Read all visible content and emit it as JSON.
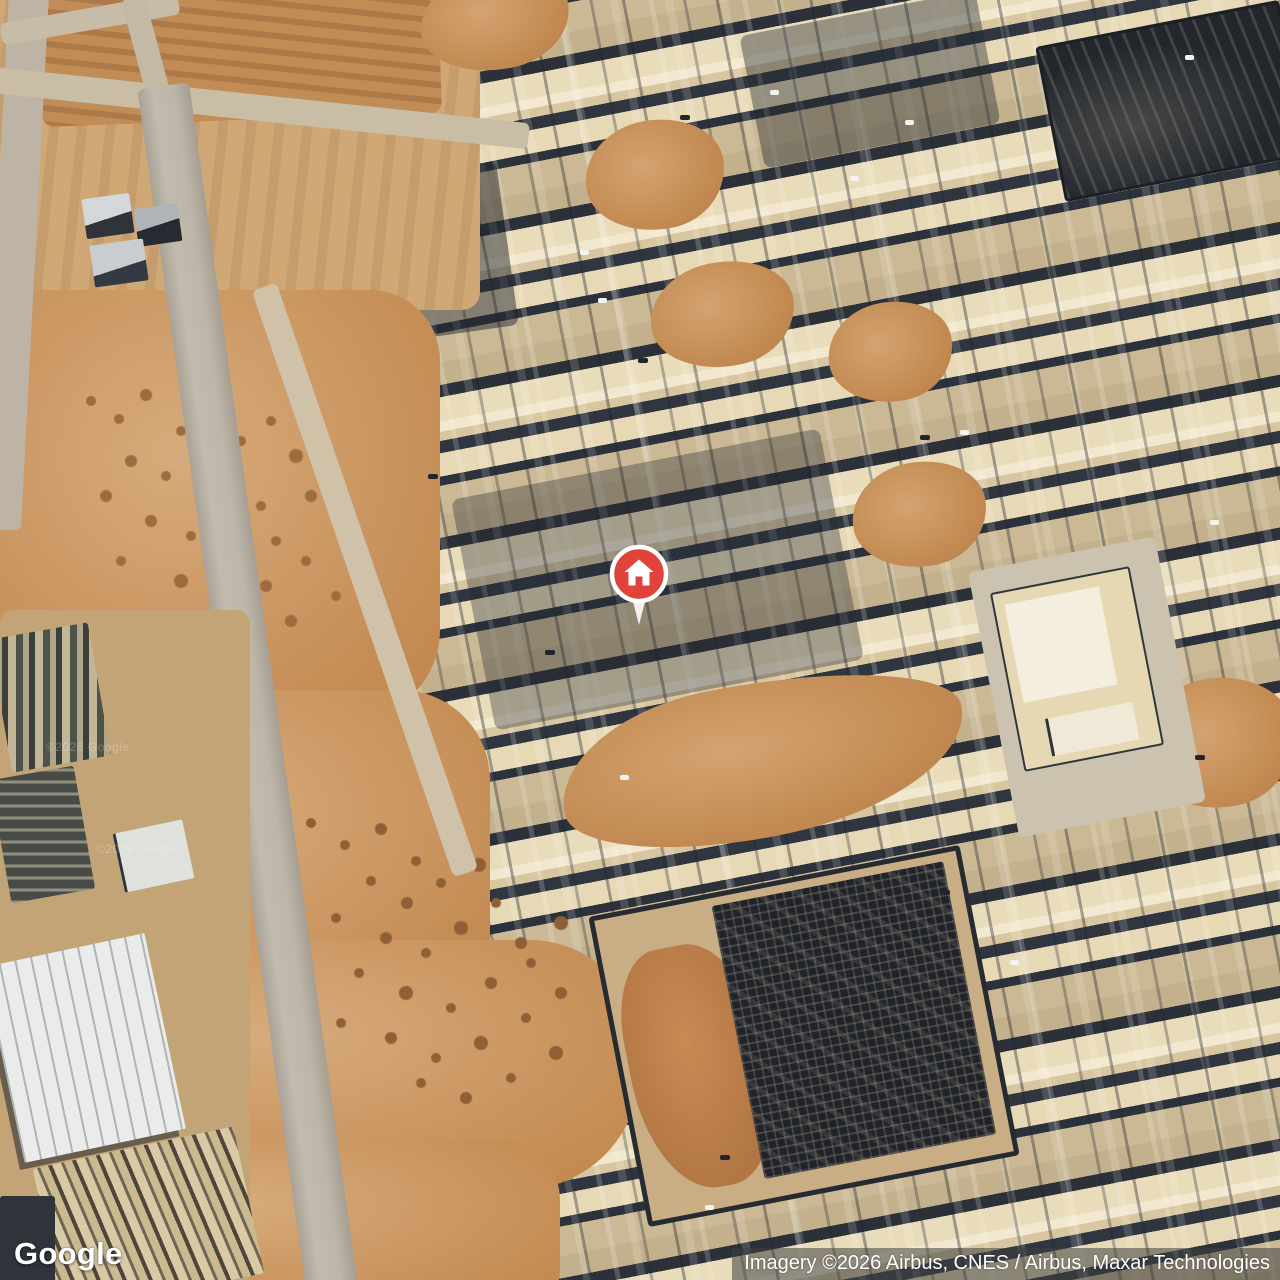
{
  "map": {
    "view": "satellite",
    "logo": "Google",
    "attribution": "Imagery ©2026 Airbus, CNES / Airbus, Maxar Technologies",
    "watermark": "©2026 Google",
    "marker": {
      "icon": "home-marker-icon",
      "color": "#DF4339",
      "x": 639,
      "y": 578
    }
  },
  "palette": {
    "desert_base": "#CDA97A",
    "dirt_orange": "#C68F58",
    "dirt_deep": "#B57C45",
    "building_beige": "#E9DCBA",
    "roof_white": "#F2E8CF",
    "shadow_dark": "#2B3039",
    "street_tan": "#CBB995",
    "road_gray": "#B5AEA2",
    "construction_dark": "#23272D",
    "warehouse_white": "#E9ECEA",
    "tree_green": "#3C4437",
    "marker_red": "#DF4339"
  }
}
